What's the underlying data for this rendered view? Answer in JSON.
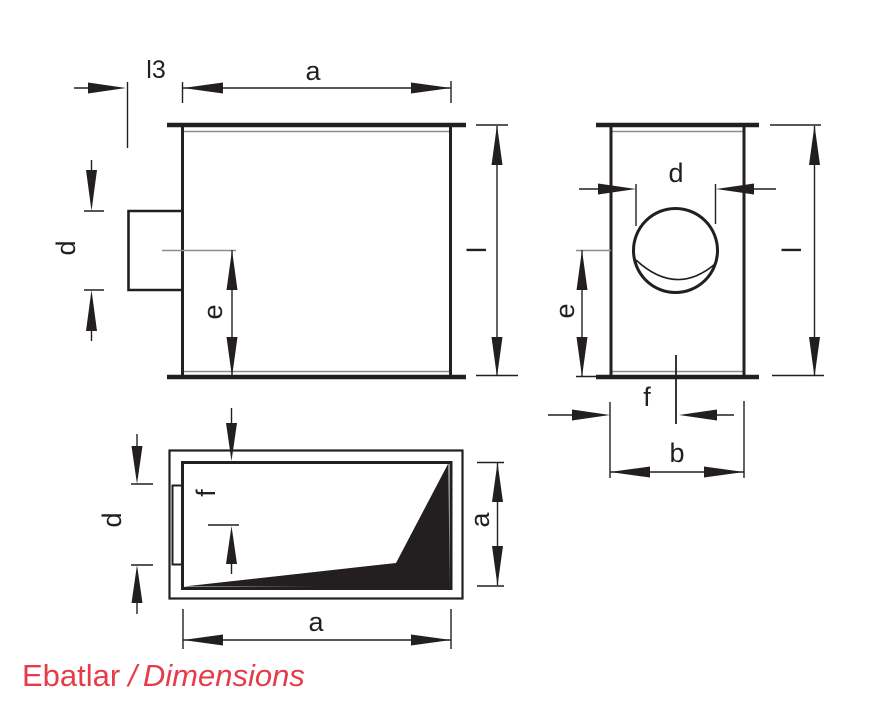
{
  "footer": {
    "label_primary": "Ebatlar",
    "separator": "/",
    "label_secondary": "Dimensions"
  },
  "colors": {
    "ink": "#231f20",
    "thin_line_gray": "#8b8d8f",
    "accent_red": "#e63c49",
    "background": "#ffffff"
  },
  "views": {
    "front": {
      "labels": {
        "l3": "l3",
        "a": "a",
        "l": "l",
        "d": "d",
        "e": "e"
      }
    },
    "side": {
      "labels": {
        "d": "d",
        "e": "e",
        "l": "l",
        "f": "f",
        "b": "b"
      }
    },
    "top": {
      "labels": {
        "f": "f",
        "d": "d",
        "a_bottom": "a",
        "a_right": "a"
      }
    }
  }
}
